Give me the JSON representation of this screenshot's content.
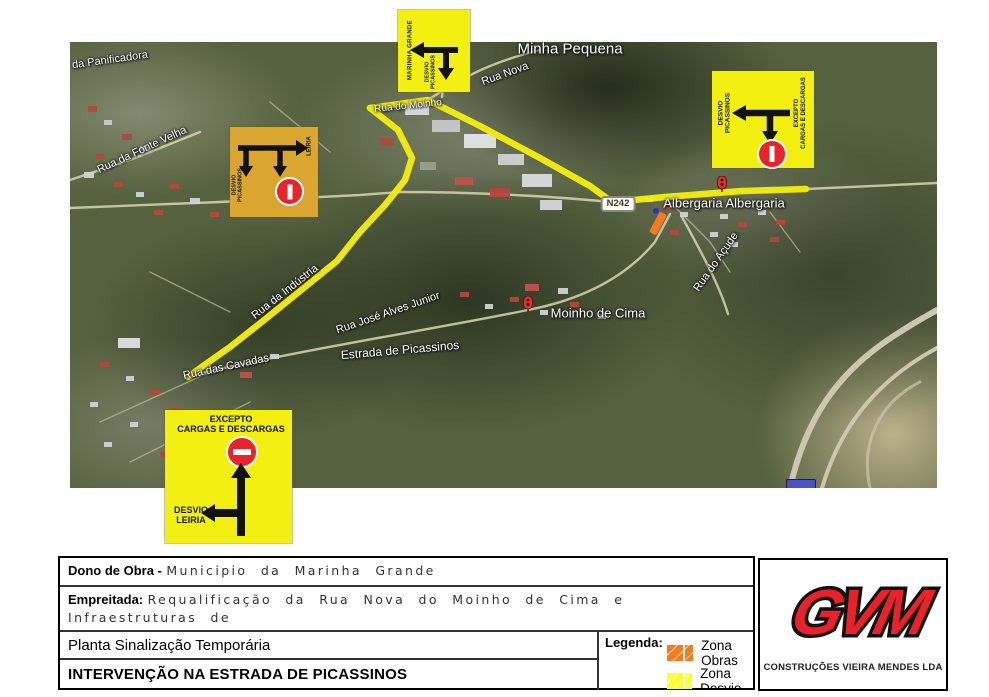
{
  "map": {
    "street_labels": {
      "minha_pequena": "Minha Pequena",
      "panificadora": "da Panificadora",
      "rua_nova": "Rua Nova",
      "fonte_velha": "Rua da Fonte Velha",
      "rua_do_moinho": "Rua do Moinho",
      "industria": "Rua da Indústria",
      "alves_junior": "Rua José Alves Junior",
      "cavadas": "Rua das Cavadas",
      "estrada_picassinos": "Estrada de Picassinos",
      "acude": "Rua do Açude",
      "albergaria": "Albergaria  Albergaria",
      "moinho_de_cima": "Moinho de Cima"
    },
    "road_badge": "N242",
    "signs": {
      "top": {
        "city": "MARINHA GRANDE",
        "detour_line1": "DESVIO",
        "detour_line2": "PICASSINOS"
      },
      "orange": {
        "destination": "LEIRIA",
        "detour_line1": "DESVIO",
        "detour_line2": "PICASSINOS"
      },
      "right": {
        "detour_line1": "DESVIO",
        "detour_line2": "PICASSINOS",
        "exception_line1": "EXCEPTO",
        "exception_line2": "CARGAS E DESCARGAS"
      },
      "bottom": {
        "exception_line1": "EXCEPTO",
        "exception_line2": "CARGAS E DESCARGAS",
        "detour_line1": "DESVIO",
        "detour_line2": "LEIRIA"
      }
    }
  },
  "title_block": {
    "owner_label": "Dono de Obra -",
    "owner_value": "Municipio da Marinha Grande",
    "contract_label": "Empreitada:",
    "contract_line1": "Requalificação da Rua Nova do Moinho de Cima e Infraestruturas de",
    "contract_line2": "Saneamento dos Arruamentos Adjacentes",
    "drawing_title": "Planta Sinalização Temporária",
    "intervention_title": "INTERVENÇÃO NA ESTRADA DE PICASSINOS",
    "legend": {
      "label": "Legenda:",
      "items": [
        {
          "label": "Zona Obras",
          "color": "#F47B20"
        },
        {
          "label": "Zona Desvio",
          "color": "#FFFF2E"
        }
      ]
    },
    "company": {
      "logo": "GVM",
      "name": "CONSTRUÇÕES VIEIRA MENDES LDA"
    }
  },
  "colors": {
    "sign_yellow": "#F2EF11",
    "sign_orange": "#DBA62F",
    "route_yellow": "#F3EC0F",
    "no_entry_red": "#E8232A",
    "logo_red": "#E8212B",
    "works_orange": "#F47B20"
  }
}
